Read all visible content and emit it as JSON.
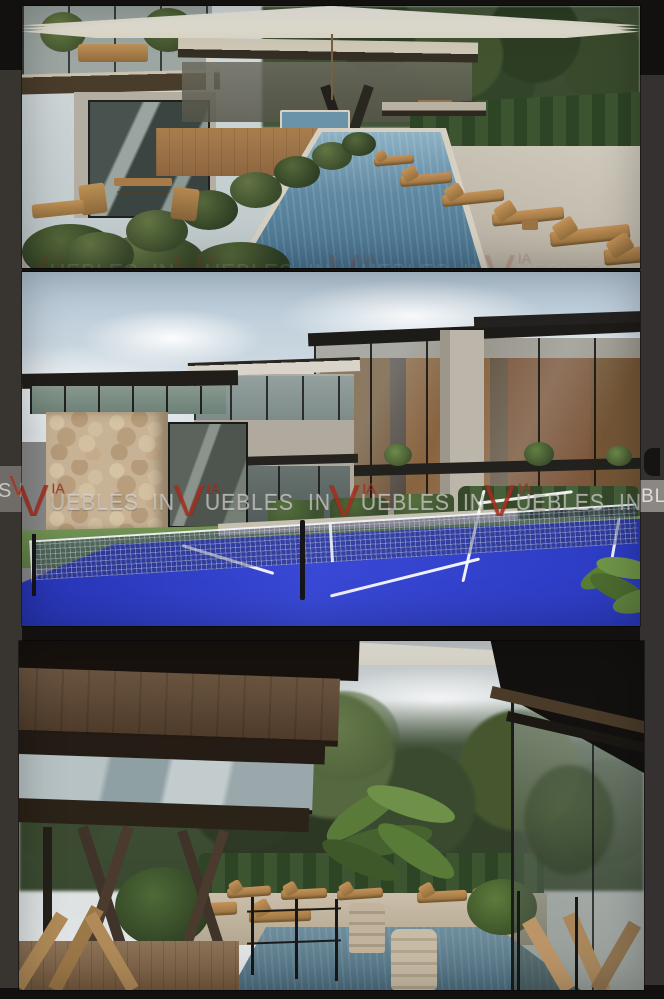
{
  "page": {
    "background": "#121110",
    "gap_color": "#161514"
  },
  "gallery": {
    "photos": [
      {
        "id": "photo-1",
        "subject": "Lap pool between modern residences and sun deck with wooden loungers and three white umbrellas"
      },
      {
        "id": "photo-2",
        "subject": "Three-story glass residences with stone volume behind a blue padel court with net"
      },
      {
        "id": "photo-3",
        "subject": "Jungle pool terrace with umbrellas, loungers, potted palms and dark timber architecture"
      }
    ],
    "adjacent_edges": {
      "left": "partial previous photo edge",
      "right": "partial next photo edge"
    }
  },
  "watermark": {
    "prefix": "IN",
    "v": "V",
    "ia": "IA",
    "suffix": "UEBLES",
    "full_brand": "VIA INMUEBLES",
    "repeats": 6,
    "left_fragment": "S IN",
    "right_fragment": "BLES I",
    "gray": "#d6d4d0",
    "red": "#a83021"
  },
  "palette": {
    "court_blue": "#3040c8",
    "pool_blue": "#5d87a0",
    "deck_tan": "#c8c2b4",
    "wood": "#b0844e",
    "foliage": "#44532f",
    "sky": "#cdd8de",
    "umbrella_white": "#f1efe6"
  }
}
